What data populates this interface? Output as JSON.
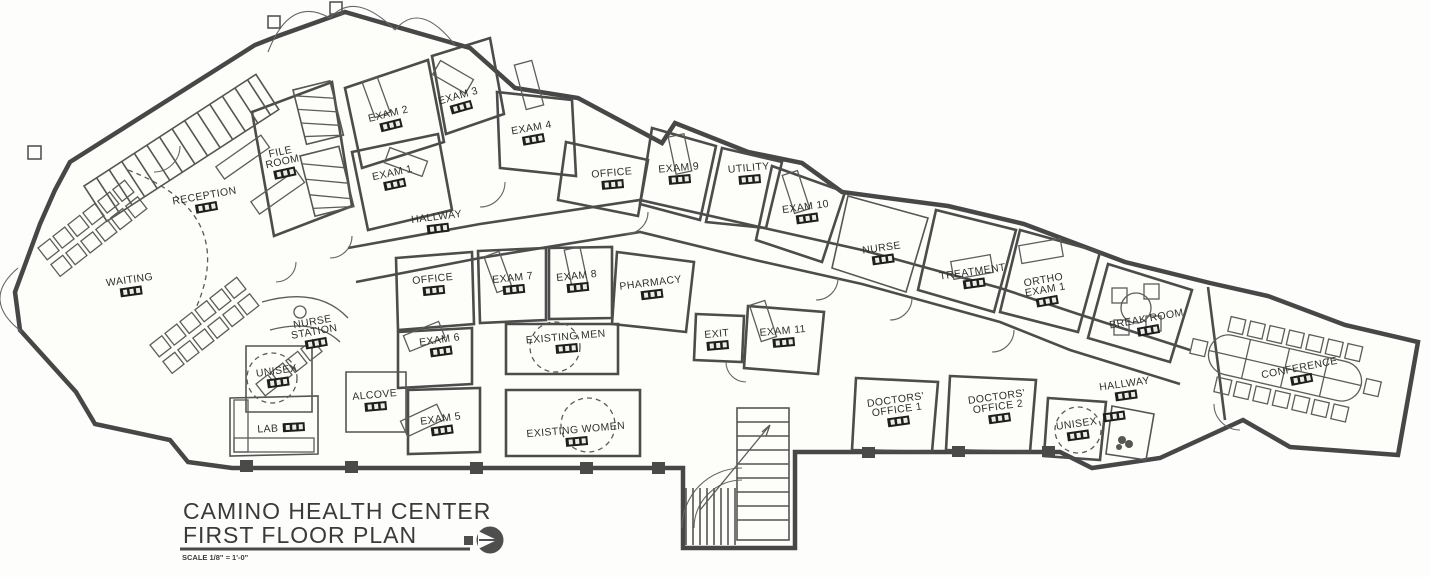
{
  "title_block": {
    "line1": "CAMINO HEALTH CENTER",
    "line2": "FIRST FLOOR PLAN",
    "scale_note": "SCALE 1/8\" = 1'-0\""
  },
  "colors": {
    "ink": "#4c4c4c",
    "paper": "#fdfdfb",
    "tag_fill": "#1e1e1e"
  },
  "icons": {
    "north_arrow": "north-arrow-icon",
    "room_number_tag": "room-number-tag"
  },
  "plan": {
    "rooms": [
      {
        "id": "reception",
        "lines": [
          "RECEPTION"
        ],
        "x": 205,
        "y": 199,
        "rot": -10,
        "tag": true
      },
      {
        "id": "file-room",
        "lines": [
          "FILE",
          "ROOM"
        ],
        "x": 281,
        "y": 155,
        "rot": -12,
        "tag": true
      },
      {
        "id": "exam-2",
        "lines": [
          "EXAM 2"
        ],
        "x": 389,
        "y": 117,
        "rot": -14,
        "tag": true
      },
      {
        "id": "exam-3",
        "lines": [
          "EXAM 3"
        ],
        "x": 459,
        "y": 99,
        "rot": -16,
        "tag": true
      },
      {
        "id": "exam-4",
        "lines": [
          "EXAM 4"
        ],
        "x": 532,
        "y": 131,
        "rot": -10,
        "tag": true
      },
      {
        "id": "exam-1",
        "lines": [
          "EXAM 1"
        ],
        "x": 393,
        "y": 176,
        "rot": -12,
        "tag": true
      },
      {
        "id": "hallway-upper",
        "lines": [
          "HALLWAY"
        ],
        "x": 437,
        "y": 220,
        "rot": -7,
        "tag": true
      },
      {
        "id": "office-upper",
        "lines": [
          "OFFICE"
        ],
        "x": 612,
        "y": 176,
        "rot": -5,
        "tag": true
      },
      {
        "id": "exam-9",
        "lines": [
          "EXAM 9"
        ],
        "x": 679,
        "y": 171,
        "rot": -5,
        "tag": true
      },
      {
        "id": "utility",
        "lines": [
          "UTILITY"
        ],
        "x": 749,
        "y": 171,
        "rot": -5,
        "tag": true
      },
      {
        "id": "exam-10",
        "lines": [
          "EXAM 10"
        ],
        "x": 806,
        "y": 210,
        "rot": -8,
        "tag": true
      },
      {
        "id": "nurse",
        "lines": [
          "NURSE"
        ],
        "x": 882,
        "y": 251,
        "rot": -8,
        "tag": true
      },
      {
        "id": "treatment",
        "lines": [
          "TREATMENT"
        ],
        "x": 973,
        "y": 275,
        "rot": -8,
        "tag": true
      },
      {
        "id": "ortho-exam-1",
        "lines": [
          "ORTHO",
          "EXAM 1"
        ],
        "x": 1044,
        "y": 283,
        "rot": -10,
        "tag": true
      },
      {
        "id": "break-room",
        "lines": [
          "BREAK ROOM"
        ],
        "x": 1147,
        "y": 322,
        "rot": -10,
        "tag": true
      },
      {
        "id": "conference",
        "lines": [
          "CONFERENCE"
        ],
        "x": 1300,
        "y": 371,
        "rot": -11,
        "tag": true
      },
      {
        "id": "waiting",
        "lines": [
          "WAITING"
        ],
        "x": 130,
        "y": 283,
        "rot": -8,
        "tag": true
      },
      {
        "id": "nurse-station",
        "lines": [
          "NURSE",
          "STATION"
        ],
        "x": 313,
        "y": 325,
        "rot": -10,
        "tag": true
      },
      {
        "id": "unisex-left",
        "lines": [
          "UNISEX"
        ],
        "x": 277,
        "y": 374,
        "rot": -8,
        "tag": true
      },
      {
        "id": "office-mid",
        "lines": [
          "OFFICE"
        ],
        "x": 433,
        "y": 282,
        "rot": -6,
        "tag": true
      },
      {
        "id": "exam-7",
        "lines": [
          "EXAM 7"
        ],
        "x": 513,
        "y": 281,
        "rot": -6,
        "tag": true
      },
      {
        "id": "exam-8",
        "lines": [
          "EXAM 8"
        ],
        "x": 577,
        "y": 279,
        "rot": -6,
        "tag": true
      },
      {
        "id": "pharmacy",
        "lines": [
          "PHARMACY"
        ],
        "x": 651,
        "y": 286,
        "rot": -7,
        "tag": true
      },
      {
        "id": "exit",
        "lines": [
          "EXIT"
        ],
        "x": 717,
        "y": 337,
        "rot": -5,
        "tag": true
      },
      {
        "id": "exam-11",
        "lines": [
          "EXAM 11"
        ],
        "x": 783,
        "y": 334,
        "rot": -5,
        "tag": true
      },
      {
        "id": "existing-men",
        "lines": [
          "EXISTING MEN"
        ],
        "x": 566,
        "y": 340,
        "rot": -5,
        "tag": true
      },
      {
        "id": "exam-6",
        "lines": [
          "EXAM 6"
        ],
        "x": 440,
        "y": 343,
        "rot": -8,
        "tag": true
      },
      {
        "id": "alcove",
        "lines": [
          "ALCOVE"
        ],
        "x": 375,
        "y": 398,
        "rot": -5,
        "tag": true
      },
      {
        "id": "exam-5",
        "lines": [
          "EXAM 5"
        ],
        "x": 441,
        "y": 422,
        "rot": -8,
        "tag": true
      },
      {
        "id": "lab",
        "lines": [
          "LAB"
        ],
        "x": 268,
        "y": 432,
        "rot": -3,
        "tag": true,
        "tag_dx": 26,
        "tag_dy": -12
      },
      {
        "id": "existing-women",
        "lines": [
          "EXISTING WOMEN"
        ],
        "x": 576,
        "y": 433,
        "rot": -5,
        "tag": true
      },
      {
        "id": "doctors-office-1",
        "lines": [
          "DOCTORS'",
          "OFFICE 1"
        ],
        "x": 896,
        "y": 403,
        "rot": -8,
        "tag": true
      },
      {
        "id": "doctors-office-2",
        "lines": [
          "DOCTORS'",
          "OFFICE 2"
        ],
        "x": 997,
        "y": 400,
        "rot": -8,
        "tag": true
      },
      {
        "id": "unisex-right",
        "lines": [
          "UNISEX"
        ],
        "x": 1077,
        "y": 427,
        "rot": -8,
        "tag": true
      },
      {
        "id": "hallway-right",
        "lines": [
          "HALLWAY"
        ],
        "x": 1125,
        "y": 387,
        "rot": -8,
        "tag": true
      },
      {
        "id": "closet",
        "lines": [],
        "x": 1113,
        "y": 408,
        "rot": -8,
        "tag": true
      }
    ]
  }
}
